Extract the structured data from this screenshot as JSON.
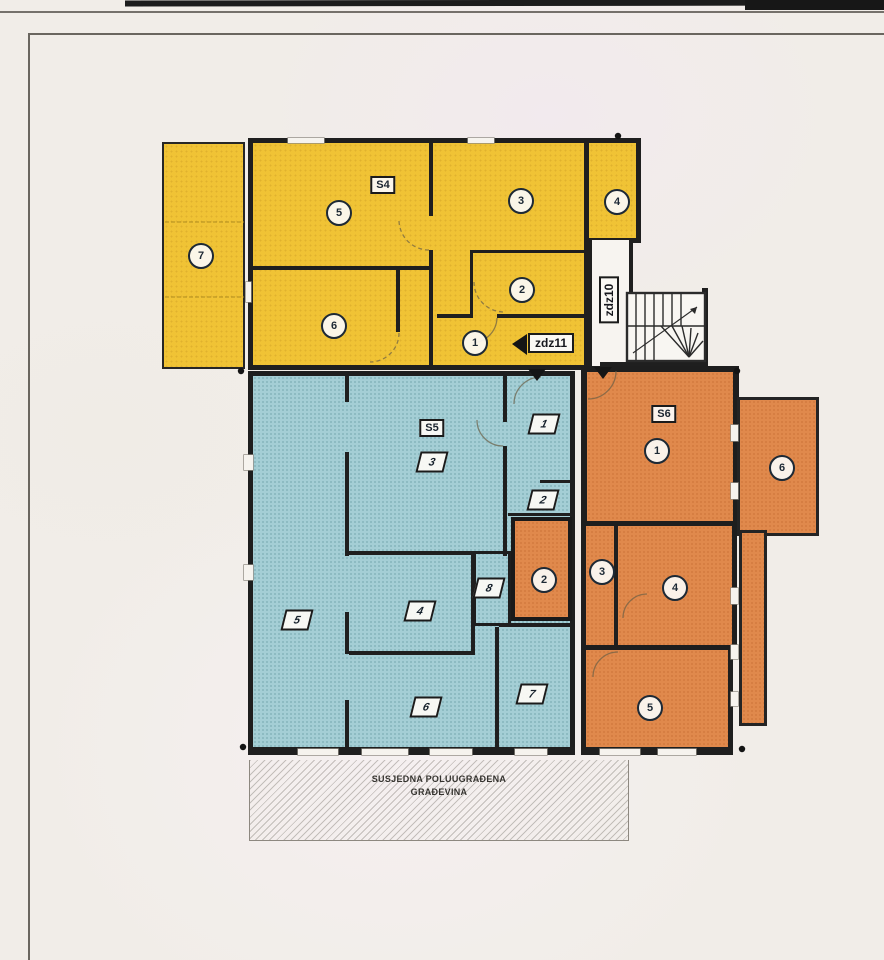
{
  "units": [
    {
      "id": "S4",
      "label": "S4",
      "color": "#f0c335",
      "rooms": [
        "1",
        "2",
        "3",
        "4",
        "5",
        "6",
        "7"
      ]
    },
    {
      "id": "S5",
      "label": "S5",
      "color": "#a4ced5",
      "rooms": [
        "1",
        "2",
        "3",
        "4",
        "5",
        "6",
        "7",
        "8"
      ]
    },
    {
      "id": "S6",
      "label": "S6",
      "color": "#e0894c",
      "rooms": [
        "1",
        "2",
        "3",
        "4",
        "5",
        "6"
      ]
    }
  ],
  "stairwell": {
    "zdz10": "zdz10",
    "zdz11": "zdz11"
  },
  "neighbor_building": {
    "line1": "SUSJEDNA POLUUGRAĐENA",
    "line2": "GRAĐEVINA"
  }
}
